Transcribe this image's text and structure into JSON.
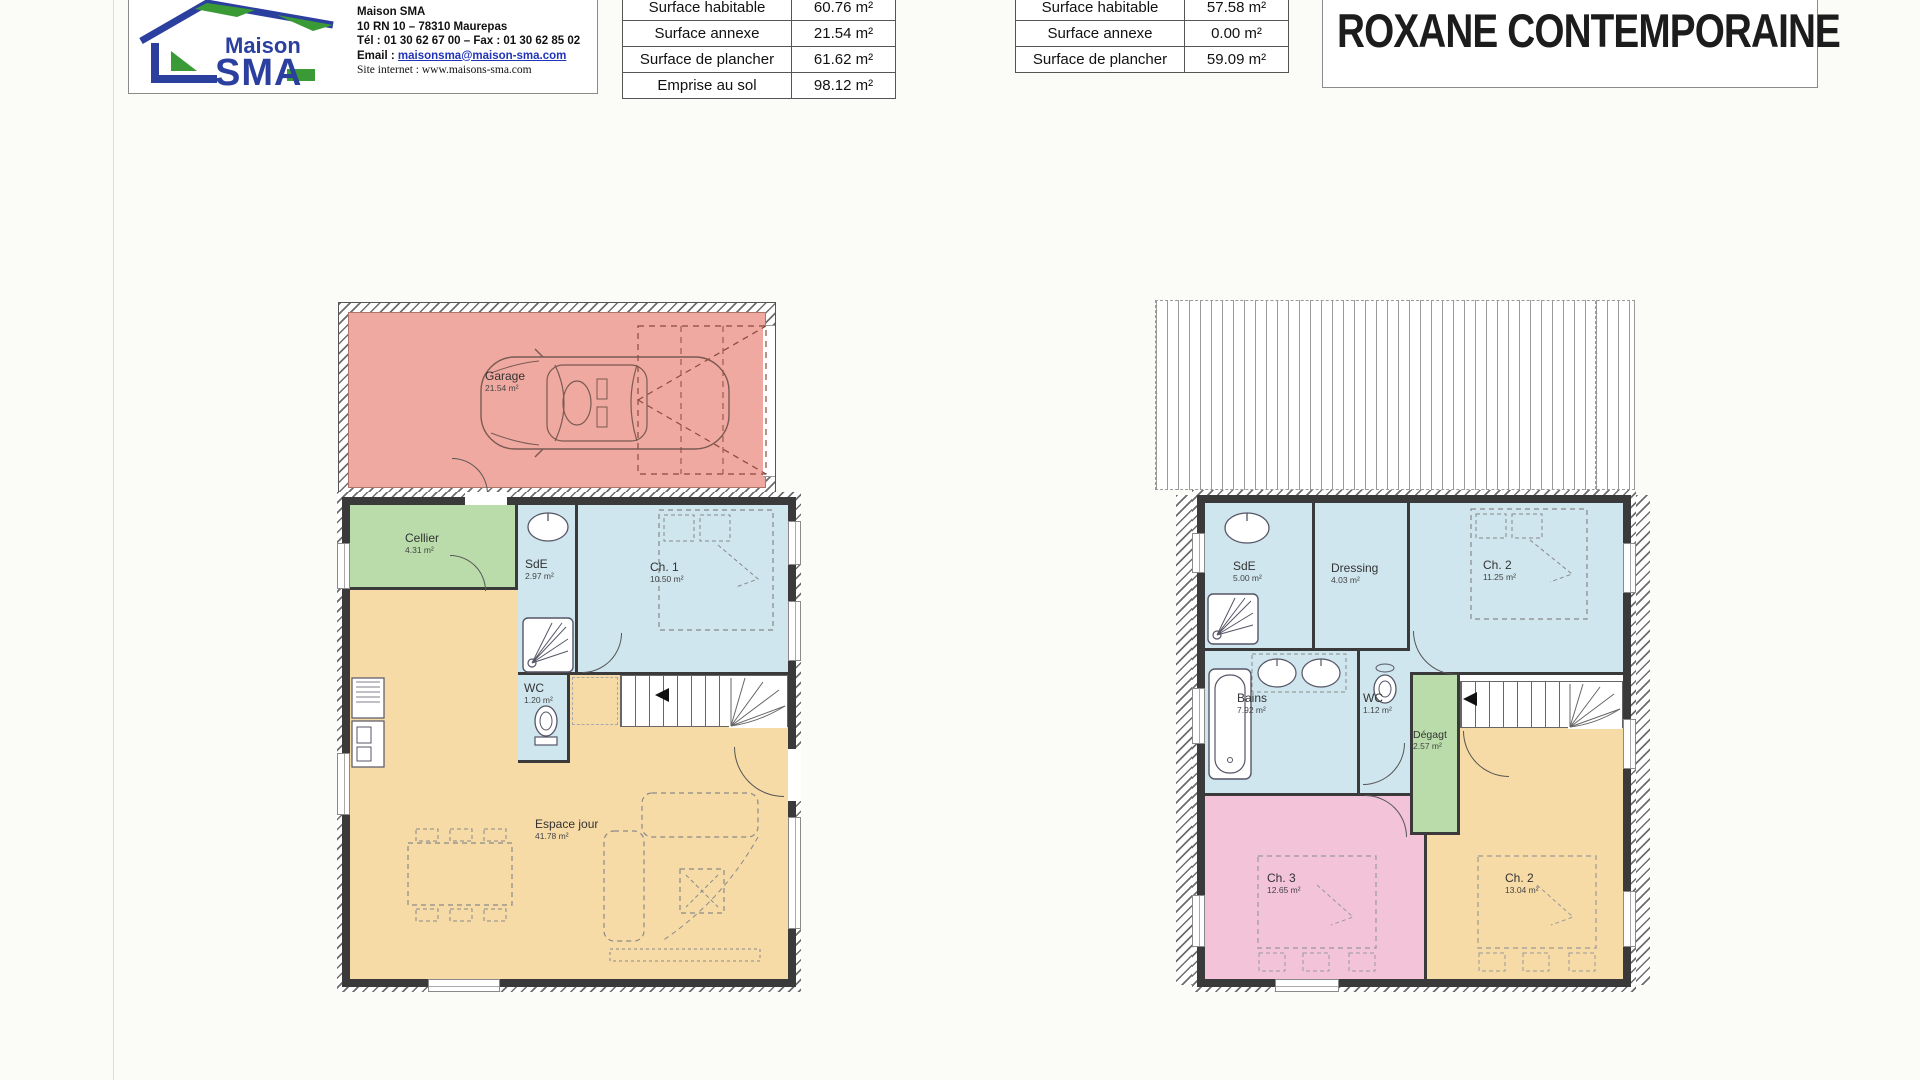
{
  "colors": {
    "wall": "#3a3a3a",
    "garage": "#efa9a0",
    "annex-green": "#b9dcaa",
    "wet-blue": "#cfe6ee",
    "living-orange": "#f6dba6",
    "bedroom-pink": "#f3c3da",
    "brand-blue": "#2b3f9e",
    "brand-green": "#3a9a35"
  },
  "header": {
    "logo": {
      "brand_top": "Maison",
      "brand_main": "SMA",
      "company": "Maison SMA",
      "address": "10 RN 10 – 78310 Maurepas",
      "phone": "Tél : 01 30 62 67 00 – Fax : 01 30 62 85 02",
      "email_label": "Email :",
      "email_value": "maisonsma@maison-sma.com",
      "website_label": "Site internet :",
      "website_value": "www.maisons-sma.com"
    },
    "title": "ROXANE CONTEMPORAINE",
    "surface_table_ground": {
      "rows": [
        {
          "label": "Surface habitable",
          "value": "60.76 m²"
        },
        {
          "label": "Surface annexe",
          "value": "21.54 m²"
        },
        {
          "label": "Surface de plancher",
          "value": "61.62 m²"
        },
        {
          "label": "Emprise au sol",
          "value": "98.12 m²"
        }
      ]
    },
    "surface_table_floor": {
      "rows": [
        {
          "label": "Surface habitable",
          "value": "57.58 m²"
        },
        {
          "label": "Surface annexe",
          "value": "0.00 m²"
        },
        {
          "label": "Surface de plancher",
          "value": "59.09 m²"
        }
      ]
    }
  },
  "plans": {
    "ground": {
      "rooms": [
        {
          "name": "Garage",
          "area": "21.54 m²"
        },
        {
          "name": "Cellier",
          "area": "4.31 m²"
        },
        {
          "name": "SdE",
          "area": "2.97 m²"
        },
        {
          "name": "Ch. 1",
          "area": "10.50 m²"
        },
        {
          "name": "WC",
          "area": "1.20 m²"
        },
        {
          "name": "Espace jour",
          "area": "41.78 m²"
        }
      ]
    },
    "floor": {
      "rooms": [
        {
          "name": "SdE",
          "area": "5.00 m²"
        },
        {
          "name": "Dressing",
          "area": "4.03 m²"
        },
        {
          "name": "Ch. 2",
          "area": "11.25 m²"
        },
        {
          "name": "Bains",
          "area": "7.92 m²"
        },
        {
          "name": "WC",
          "area": "1.12 m²"
        },
        {
          "name": "Dégagt",
          "area": "2.57 m²"
        },
        {
          "name": "Ch. 3",
          "area": "12.65 m²"
        },
        {
          "name": "Ch. 2",
          "area": "13.04 m²"
        }
      ]
    }
  }
}
